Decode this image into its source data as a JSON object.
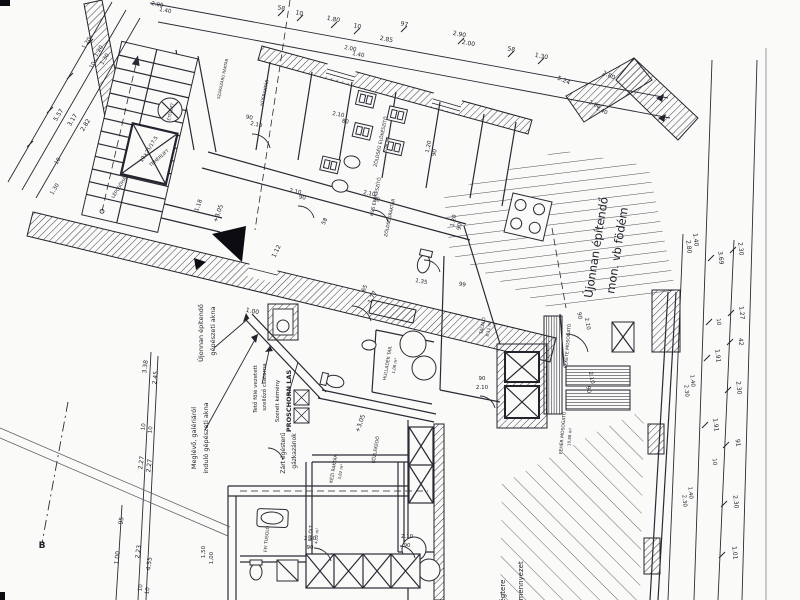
{
  "meta": {
    "drawing_type": "architectural floor plan (scanned)",
    "language": "hu"
  },
  "palette": {
    "paper": "#fafaf8",
    "ink": "#23232e",
    "hatch": "#3d3d48",
    "black": "#0c0c12"
  },
  "texts": {
    "notes": [
      {
        "n": "note-new-shaft-1",
        "t": "Újonnan építendő",
        "x": 203,
        "y": 333,
        "r": -90,
        "s": 6.5
      },
      {
        "n": "note-new-shaft-2",
        "t": "gépészeti akna",
        "x": 215,
        "y": 331,
        "r": -90,
        "s": 6.5
      },
      {
        "n": "note-roof-duct-1",
        "t": "Tető fölé vezetett",
        "x": 257,
        "y": 389,
        "r": -90,
        "s": 5.5
      },
      {
        "n": "note-roof-duct-2",
        "t": "szellőző csatorna",
        "x": 266,
        "y": 387,
        "r": -90,
        "s": 5.5
      },
      {
        "n": "note-chimney-1",
        "t": "Szerelt kémény",
        "x": 279,
        "y": 401,
        "r": -90,
        "s": 5.5
      },
      {
        "n": "note-chimney-2",
        "t": "PROSCHORN LAS",
        "x": 291,
        "y": 401,
        "r": -90,
        "s": 6.5,
        "w": 600
      },
      {
        "n": "note-existing-shaft-1",
        "t": "Meglévő, galériáról",
        "x": 196,
        "y": 438,
        "r": -90,
        "s": 6.5
      },
      {
        "n": "note-existing-shaft-2",
        "t": "induló gépészeti akna",
        "x": 208,
        "y": 438,
        "r": -90,
        "s": 6.5
      },
      {
        "n": "note-boilers-1",
        "t": "Zárt égésterű",
        "x": 285,
        "y": 453,
        "r": -90,
        "s": 6
      },
      {
        "n": "note-boilers-2",
        "t": "gázkazánok",
        "x": 296,
        "y": 451,
        "r": -90,
        "s": 6
      },
      {
        "n": "note-new-slab-1",
        "t": "Újonnan építendő",
        "x": 600,
        "y": 248,
        "r": -81,
        "s": 11.5,
        "w": 500
      },
      {
        "n": "note-new-slab-2",
        "t": "mon. vb födém",
        "x": 621,
        "y": 251,
        "r": -81,
        "s": 11.5,
        "w": 500
      },
      {
        "n": "note-airspace",
        "t": "légtere",
        "x": 505,
        "y": 592,
        "r": -90,
        "s": 7
      },
      {
        "n": "note-ceiling",
        "t": "álmennyezet",
        "x": 523,
        "y": 584,
        "r": -90,
        "s": 7
      },
      {
        "n": "section-marker-b",
        "t": "B",
        "x": 42,
        "y": 548,
        "r": 0,
        "s": 9,
        "w": 700
      }
    ],
    "rooms": [
      {
        "n": "room-husraktar",
        "t": "HÚSRAKTÁR",
        "x": 266,
        "y": 93,
        "r": -78,
        "s": 4.5
      },
      {
        "n": "room-szarazaru",
        "t": "SZÁRAZÁRU RAKTÁR",
        "x": 224,
        "y": 79,
        "r": -78,
        "s": 4
      },
      {
        "n": "room-zoldseg-elokeszito",
        "t": "ZÖLDSÉG ELŐKÉSZÍTŐ",
        "x": 382,
        "y": 142,
        "r": -78,
        "s": 4.5
      },
      {
        "n": "room-zoldseg-area",
        "t": "5,98 m²",
        "x": 388,
        "y": 145,
        "r": -78,
        "s": 4
      },
      {
        "n": "room-hus-elokeszito",
        "t": "HÚS ELŐKÉSZÍTŐ",
        "x": 377,
        "y": 197,
        "r": -78,
        "s": 4.5
      },
      {
        "n": "room-zoldsegraktar",
        "t": "ZÖLDSÉGRAKTÁR",
        "x": 391,
        "y": 218,
        "r": -78,
        "s": 4.5
      },
      {
        "n": "room-talalo",
        "t": "TÁLALÓ",
        "x": 484,
        "y": 326,
        "r": -80,
        "s": 4.5
      },
      {
        "n": "room-talalo-area",
        "t": "8,11 m²",
        "x": 490,
        "y": 329,
        "r": -80,
        "s": 4
      },
      {
        "n": "room-hulladek",
        "t": "HULLADÉK TÁR.",
        "x": 389,
        "y": 363,
        "r": -80,
        "s": 4.5
      },
      {
        "n": "room-hulladek-area",
        "t": "1,08 m²",
        "x": 396,
        "y": 366,
        "r": -80,
        "s": 4
      },
      {
        "n": "room-kezi-raktar",
        "t": "KÉZI RAKTÁR",
        "x": 335,
        "y": 469,
        "r": -80,
        "s": 4.5
      },
      {
        "n": "room-kezi-area",
        "t": "3,82 m²",
        "x": 342,
        "y": 472,
        "r": -80,
        "s": 4
      },
      {
        "n": "room-kozlekedo",
        "t": "KÖZLEKEDŐ",
        "x": 377,
        "y": 450,
        "r": -80,
        "s": 4.5
      },
      {
        "n": "room-ffi-olt",
        "t": "FFI ÖLT.",
        "x": 312,
        "y": 533,
        "r": -85,
        "s": 4.5
      },
      {
        "n": "room-ffi-olt-area",
        "t": "4,02 m²",
        "x": 318,
        "y": 536,
        "r": -85,
        "s": 4
      },
      {
        "n": "room-ffi-tusolo",
        "t": "FFI TUSOLÓ",
        "x": 268,
        "y": 539,
        "r": -85,
        "s": 4.5
      },
      {
        "n": "room-fekete-mosogato",
        "t": "FEKETE MOSOGATÓ",
        "x": 569,
        "y": 346,
        "r": -85,
        "s": 4.5
      },
      {
        "n": "room-feher-mosogato",
        "t": "FEHÉR MOSOGATÓ",
        "x": 564,
        "y": 433,
        "r": -85,
        "s": 4.5
      },
      {
        "n": "room-feher-area",
        "t": "10,88 m²",
        "x": 571,
        "y": 437,
        "r": -85,
        "s": 4
      },
      {
        "n": "room-teherlift",
        "t": "TEHERLIFT",
        "x": 160,
        "y": 159,
        "r": -40,
        "s": 4.5
      },
      {
        "n": "room-etellift",
        "t": "ÉTELLIFT",
        "x": 172,
        "y": 112,
        "r": -78,
        "s": 4
      },
      {
        "n": "room-lepcsohaz",
        "t": "LÉPCSŐHÁZ",
        "x": 121,
        "y": 187,
        "r": -58,
        "s": 4.5
      }
    ],
    "dims": [
      {
        "t": "58",
        "x": 281,
        "y": 10,
        "r": 11
      },
      {
        "t": "10",
        "x": 299,
        "y": 15,
        "r": 11
      },
      {
        "t": "1.80",
        "x": 333,
        "y": 21,
        "r": 11
      },
      {
        "t": "10",
        "x": 357,
        "y": 28,
        "r": 11
      },
      {
        "t": "97",
        "x": 404,
        "y": 26,
        "r": 11
      },
      {
        "t": "2.85",
        "x": 386,
        "y": 41,
        "r": 11
      },
      {
        "t": "2.90",
        "x": 459,
        "y": 36,
        "r": 11
      },
      {
        "t": "2.00",
        "x": 468,
        "y": 45,
        "r": 11
      },
      {
        "t": "58",
        "x": 511,
        "y": 51,
        "r": 11
      },
      {
        "t": "1.30",
        "x": 541,
        "y": 58,
        "r": 11
      },
      {
        "t": "5.24",
        "x": 563,
        "y": 82,
        "r": 24
      },
      {
        "t": "2.80",
        "x": 608,
        "y": 77,
        "r": 24
      },
      {
        "t": "2.00",
        "x": 157,
        "y": 6,
        "r": 11,
        "s": 5.5
      },
      {
        "t": "1.40",
        "x": 165,
        "y": 12,
        "r": 11,
        "s": 5.5
      },
      {
        "t": "2.00",
        "x": 350,
        "y": 50,
        "r": 11,
        "s": 5.5
      },
      {
        "t": "1.40",
        "x": 358,
        "y": 56,
        "r": 11,
        "s": 5.5
      },
      {
        "t": "2.80",
        "x": 594,
        "y": 106,
        "r": 24,
        "s": 5.5
      },
      {
        "t": "1.40",
        "x": 601,
        "y": 112,
        "r": 24,
        "s": 5.5
      },
      {
        "t": "5.57",
        "x": 60,
        "y": 116,
        "r": -58
      },
      {
        "t": "3.17",
        "x": 74,
        "y": 121,
        "r": -58
      },
      {
        "t": "2.82",
        "x": 87,
        "y": 126,
        "r": -58
      },
      {
        "t": "1.20",
        "x": 88,
        "y": 44,
        "r": -58,
        "s": 5.5
      },
      {
        "t": "1.20",
        "x": 100,
        "y": 52,
        "r": -58,
        "s": 5.5
      },
      {
        "t": "10",
        "x": 94,
        "y": 66,
        "r": -58,
        "s": 5.5
      },
      {
        "t": "1.30",
        "x": 106,
        "y": 60,
        "r": -58,
        "s": 5.5
      },
      {
        "t": "10",
        "x": 59,
        "y": 162,
        "r": -58,
        "s": 5.5
      },
      {
        "t": "1.30",
        "x": 56,
        "y": 190,
        "r": -58,
        "s": 5.5
      },
      {
        "t": "3.38",
        "x": 147,
        "y": 367,
        "r": -82
      },
      {
        "t": "2.45",
        "x": 157,
        "y": 378,
        "r": -82
      },
      {
        "t": "10",
        "x": 145,
        "y": 427,
        "r": -82,
        "s": 5.5
      },
      {
        "t": "10",
        "x": 152,
        "y": 430,
        "r": -82,
        "s": 5.5
      },
      {
        "t": "2.27",
        "x": 143,
        "y": 463,
        "r": -82
      },
      {
        "t": "2.27",
        "x": 151,
        "y": 466,
        "r": -82
      },
      {
        "t": "95",
        "x": 123,
        "y": 521,
        "r": -82
      },
      {
        "t": "1.00",
        "x": 119,
        "y": 558,
        "r": -82
      },
      {
        "t": "2.23",
        "x": 140,
        "y": 552,
        "r": -82
      },
      {
        "t": "4.55",
        "x": 151,
        "y": 564,
        "r": -82
      },
      {
        "t": "10",
        "x": 142,
        "y": 588,
        "r": -82,
        "s": 5.5
      },
      {
        "t": "10",
        "x": 149,
        "y": 591,
        "r": -82,
        "s": 5.5
      },
      {
        "t": "+3,05",
        "x": 220,
        "y": 214,
        "r": -70
      },
      {
        "t": "+3,05",
        "x": 362,
        "y": 424,
        "r": -70
      },
      {
        "t": "1.18",
        "x": 200,
        "y": 206,
        "r": -70,
        "s": 5.5
      },
      {
        "t": "1.12",
        "x": 278,
        "y": 252,
        "r": -64
      },
      {
        "t": "65",
        "x": 366,
        "y": 289,
        "r": -64,
        "s": 5.5
      },
      {
        "t": "1.77",
        "x": 374,
        "y": 298,
        "r": -64
      },
      {
        "t": "58",
        "x": 326,
        "y": 222,
        "r": -64,
        "s": 5.5
      },
      {
        "t": "1.00",
        "x": 252,
        "y": 313,
        "r": 11
      },
      {
        "t": "1.35",
        "x": 421,
        "y": 283,
        "r": 11,
        "s": 5.5
      },
      {
        "t": "99",
        "x": 462,
        "y": 286,
        "r": 11,
        "s": 5.5
      },
      {
        "t": "90",
        "x": 249,
        "y": 119,
        "r": 11,
        "s": 5.5
      },
      {
        "t": "2.10",
        "x": 256,
        "y": 126,
        "r": 11,
        "s": 5.5
      },
      {
        "t": "2.10",
        "x": 338,
        "y": 116,
        "r": 11,
        "s": 5.5
      },
      {
        "t": "80",
        "x": 345,
        "y": 123,
        "r": 11,
        "s": 5.5
      },
      {
        "t": "2.10",
        "x": 295,
        "y": 193,
        "r": 11,
        "s": 5.5
      },
      {
        "t": "90",
        "x": 302,
        "y": 199,
        "r": 11,
        "s": 5.5
      },
      {
        "t": "2.10",
        "x": 369,
        "y": 195,
        "r": 11,
        "s": 5.5
      },
      {
        "t": "90",
        "x": 376,
        "y": 201,
        "r": 11,
        "s": 5.5
      },
      {
        "t": "1.20",
        "x": 430,
        "y": 147,
        "r": -78,
        "s": 5.5
      },
      {
        "t": "90",
        "x": 436,
        "y": 153,
        "r": -78,
        "s": 5.5
      },
      {
        "t": "1.20",
        "x": 455,
        "y": 221,
        "r": -78,
        "s": 5.5
      },
      {
        "t": "90",
        "x": 461,
        "y": 227,
        "r": -78,
        "s": 5.5
      },
      {
        "t": "90",
        "x": 578,
        "y": 316,
        "r": 80,
        "s": 5.5
      },
      {
        "t": "2.10",
        "x": 586,
        "y": 324,
        "r": 80,
        "s": 5.5
      },
      {
        "t": "2.10",
        "x": 590,
        "y": 378,
        "r": 80,
        "s": 5.5
      },
      {
        "t": "90",
        "x": 587,
        "y": 390,
        "r": 80,
        "s": 5.5
      },
      {
        "t": "90",
        "x": 482,
        "y": 380,
        "r": 0,
        "s": 5.5
      },
      {
        "t": "2.10",
        "x": 482,
        "y": 389,
        "r": 0,
        "s": 5.5
      },
      {
        "t": "2.10",
        "x": 310,
        "y": 540,
        "r": 0,
        "s": 5.5
      },
      {
        "t": "90",
        "x": 310,
        "y": 549,
        "r": 0,
        "s": 5.5
      },
      {
        "t": "2.10",
        "x": 407,
        "y": 538,
        "r": 0,
        "s": 5.5
      },
      {
        "t": "90",
        "x": 407,
        "y": 547,
        "r": 0,
        "s": 5.5
      },
      {
        "t": "1,50",
        "x": 205,
        "y": 552,
        "r": -90,
        "s": 5.5
      },
      {
        "t": "1,00",
        "x": 213,
        "y": 558,
        "r": -90,
        "s": 5.5
      },
      {
        "t": "2.80",
        "x": 687,
        "y": 247,
        "r": 84
      },
      {
        "t": "1.40",
        "x": 694,
        "y": 240,
        "r": 84
      },
      {
        "t": "3.69",
        "x": 719,
        "y": 258,
        "r": 84
      },
      {
        "t": "10",
        "x": 717,
        "y": 322,
        "r": 84,
        "s": 5.5
      },
      {
        "t": "1.91",
        "x": 716,
        "y": 356,
        "r": 84
      },
      {
        "t": "1.91",
        "x": 714,
        "y": 425,
        "r": 84
      },
      {
        "t": "10",
        "x": 713,
        "y": 462,
        "r": 84,
        "s": 5.5
      },
      {
        "t": "2.30",
        "x": 739,
        "y": 249,
        "r": 84
      },
      {
        "t": "1.27",
        "x": 740,
        "y": 313,
        "r": 84
      },
      {
        "t": "42",
        "x": 739,
        "y": 342,
        "r": 84
      },
      {
        "t": "2.30",
        "x": 737,
        "y": 388,
        "r": 84
      },
      {
        "t": "91",
        "x": 736,
        "y": 443,
        "r": 84
      },
      {
        "t": "2.30",
        "x": 734,
        "y": 502,
        "r": 84
      },
      {
        "t": "1.01",
        "x": 733,
        "y": 553,
        "r": 84
      },
      {
        "t": "1.40",
        "x": 691,
        "y": 381,
        "r": 84,
        "s": 5.5
      },
      {
        "t": "2.30",
        "x": 685,
        "y": 391,
        "r": 84,
        "s": 5.5
      },
      {
        "t": "1.40",
        "x": 689,
        "y": 493,
        "r": 84,
        "s": 5.5
      },
      {
        "t": "2.30",
        "x": 683,
        "y": 501,
        "r": 84,
        "s": 5.5
      },
      {
        "t": "19×25/17,5",
        "x": 150,
        "y": 150,
        "r": -58,
        "s": 5
      }
    ]
  }
}
